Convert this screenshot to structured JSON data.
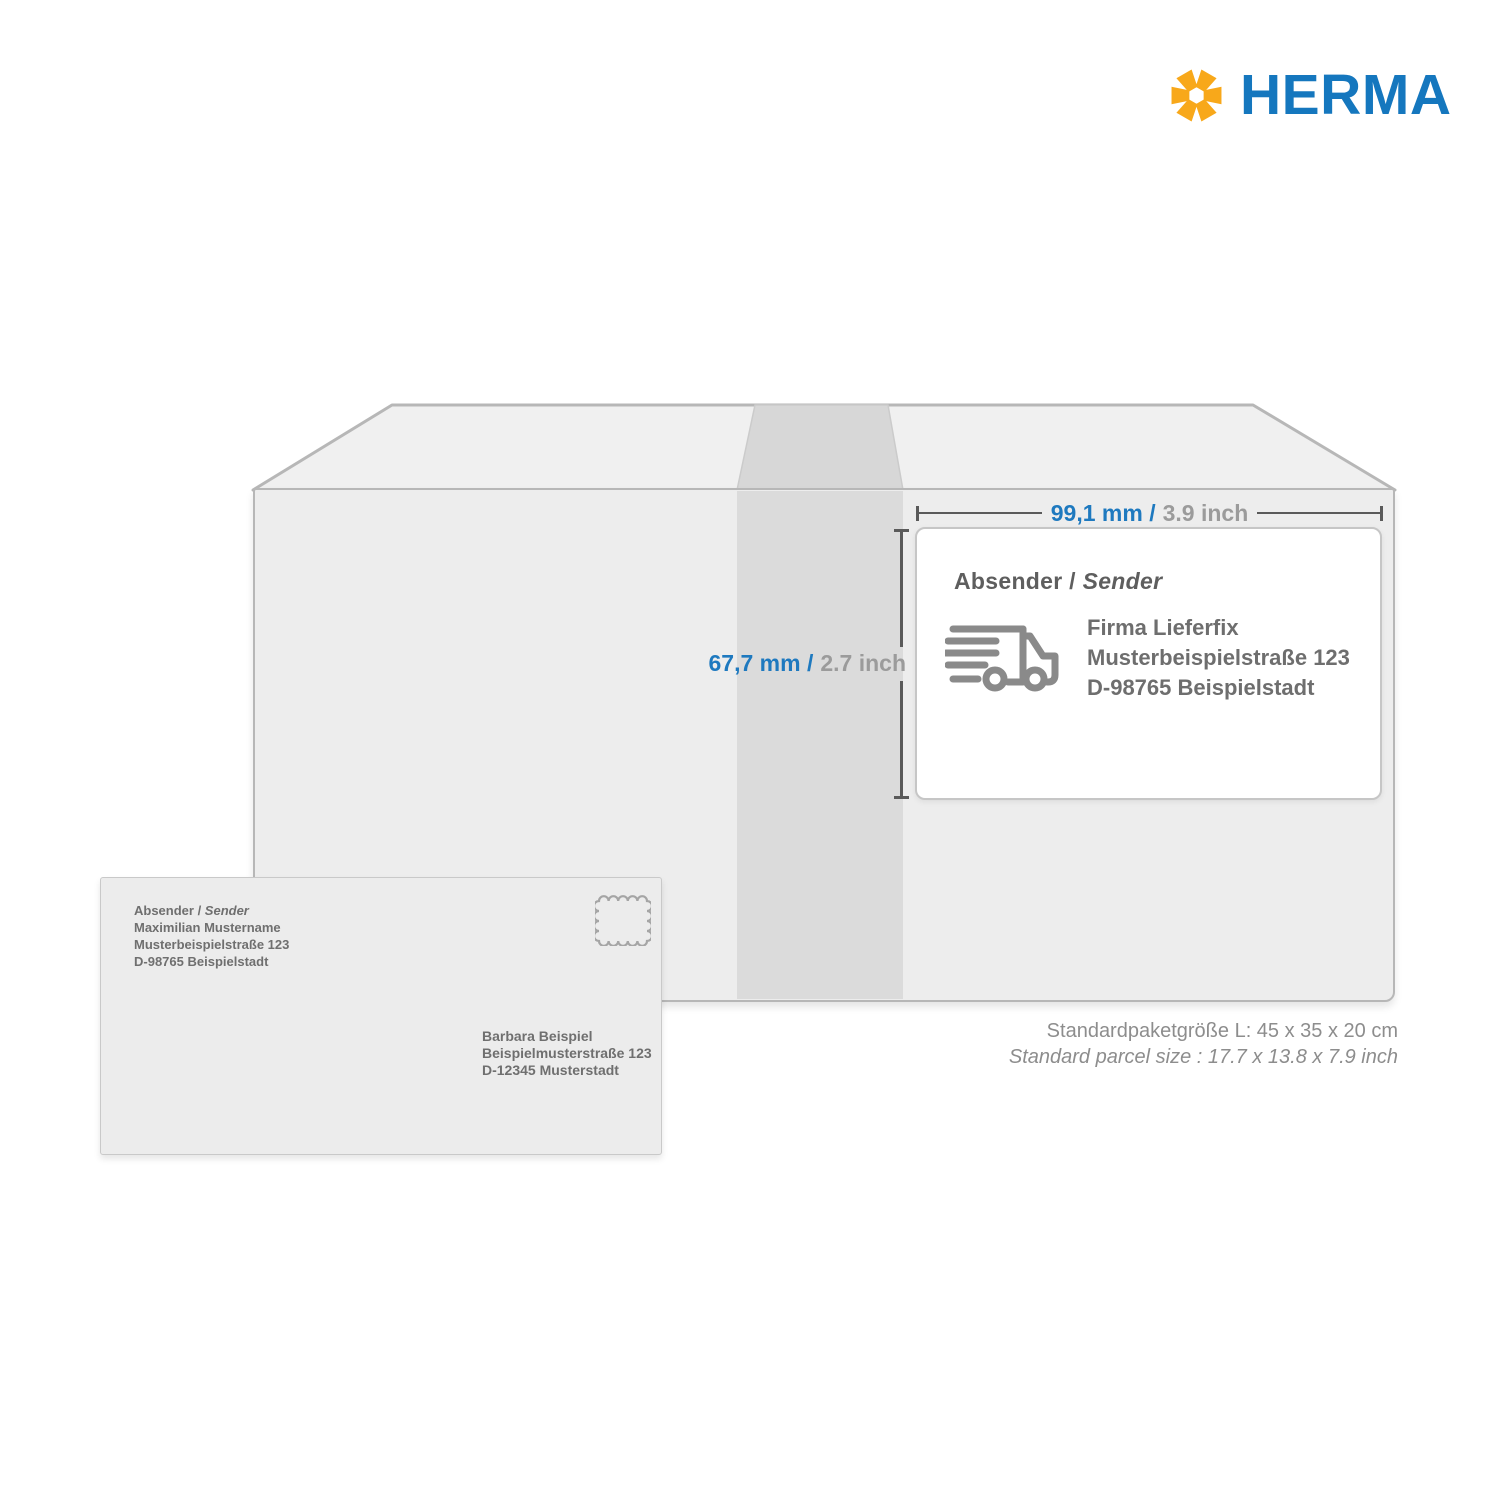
{
  "brand": {
    "wordmark": "HERMA"
  },
  "parcel": {
    "width_label": {
      "metric": "99,1 mm /",
      "imperial": "3.9 inch"
    },
    "height_label": {
      "metric": "67,7 mm /",
      "imperial": "2.7 inch"
    },
    "shipping_label": {
      "heading_prefix": "Absender / ",
      "heading_italic": "Sender",
      "address_lines": [
        "Firma Lieferfix",
        "Musterbeispielstraße 123",
        "D-98765 Beispielstadt"
      ]
    },
    "size_note_de": "Standardpaketgröße L: 45 x 35 x 20 cm",
    "size_note_en": "Standard parcel size : 17.7 x 13.8 x 7.9 inch"
  },
  "envelope": {
    "sender_heading_prefix": "Absender / ",
    "sender_heading_italic": "Sender",
    "sender_lines": [
      "Maximilian Mustername",
      "Musterbeispielstraße 123",
      "D-98765 Beispielstadt"
    ],
    "recipient_lines": [
      "Barbara Beispiel",
      "Beispielmusterstraße 123",
      "D-12345 Musterstadt"
    ]
  },
  "colors": {
    "brand_blue": "#1577BE",
    "brand_yellow": "#F8A81A",
    "dimension_metric_blue": "#1E79BF",
    "dimension_imperial_gray": "#9B9B9B",
    "box_face": "#EDEDED",
    "box_tape_band": "#DBDBDB",
    "outline_gray": "#B7B7B7",
    "icon_gray": "#8A8A8A",
    "text_gray": "#6E6E6E"
  }
}
